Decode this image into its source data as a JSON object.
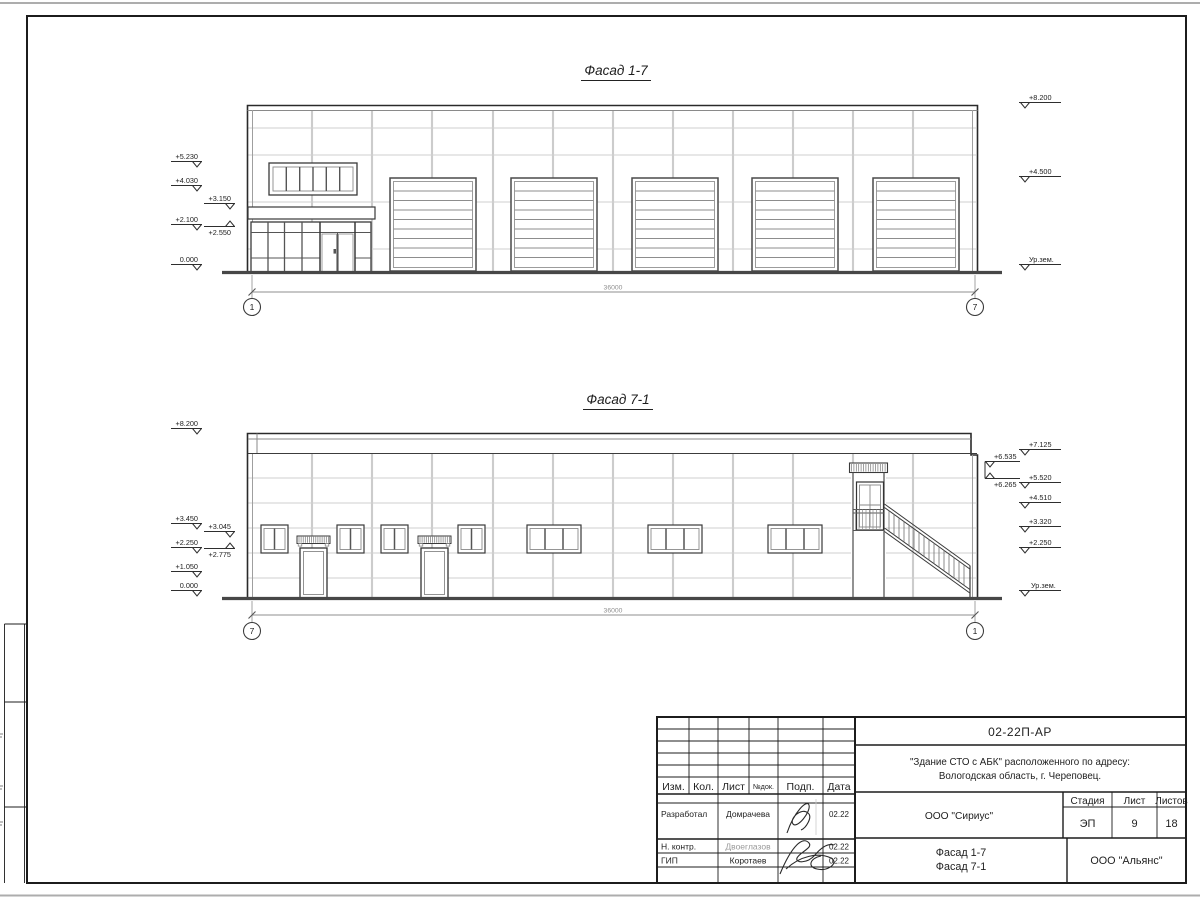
{
  "sheet": {
    "facade_top": {
      "title": "Фасад 1-7",
      "dimension": "36000",
      "axis_left": "1",
      "axis_right": "7",
      "elev_left": [
        "+5.230",
        "+4.030",
        "+3.150",
        "+2.100",
        "+2.550",
        "0.000"
      ],
      "elev_right": [
        "+8.200",
        "+4.500",
        "Ур.зем."
      ]
    },
    "facade_bottom": {
      "title": "Фасад 7-1",
      "dimension": "36000",
      "axis_left": "7",
      "axis_right": "1",
      "elev_left": [
        "+8.200",
        "+3.450",
        "+3.045",
        "+2.250",
        "+2.775",
        "+1.050",
        "0.000"
      ],
      "elev_right": [
        "+7.125",
        "+6.535",
        "+6.265",
        "+5.520",
        "+4.510",
        "+3.320",
        "+2.250",
        "Ур.зем."
      ]
    },
    "title_block": {
      "doc_number": "02-22П-АР",
      "project_line1": "\"Здание СТО с АБК\" расположенного по адресу:",
      "project_line2": "Вологодская область, г. Череповец.",
      "headers": {
        "izm": "Изм.",
        "kol": "Кол.",
        "list": "Лист",
        "doc": "№док.",
        "sign": "Подп.",
        "date": "Дата"
      },
      "rows": [
        {
          "role": "Разработал",
          "name": "Домрачева",
          "date": "02.22"
        },
        {
          "role": "Н. контр.",
          "name": "Двоеглазов",
          "date": "02.22"
        },
        {
          "role": "ГИП",
          "name": "Коротаев",
          "date": "02.22"
        }
      ],
      "designer_org": "ООО \"Сириус\"",
      "stage_header": "Стадия",
      "sheet_header": "Лист",
      "sheets_header": "Листов",
      "stage": "ЭП",
      "sheet_no": "9",
      "sheets_total": "18",
      "drawing_title_line1": "Фасад 1-7",
      "drawing_title_line2": "Фасад 7-1",
      "contractor_org": "ООО \"Альянс\""
    }
  }
}
